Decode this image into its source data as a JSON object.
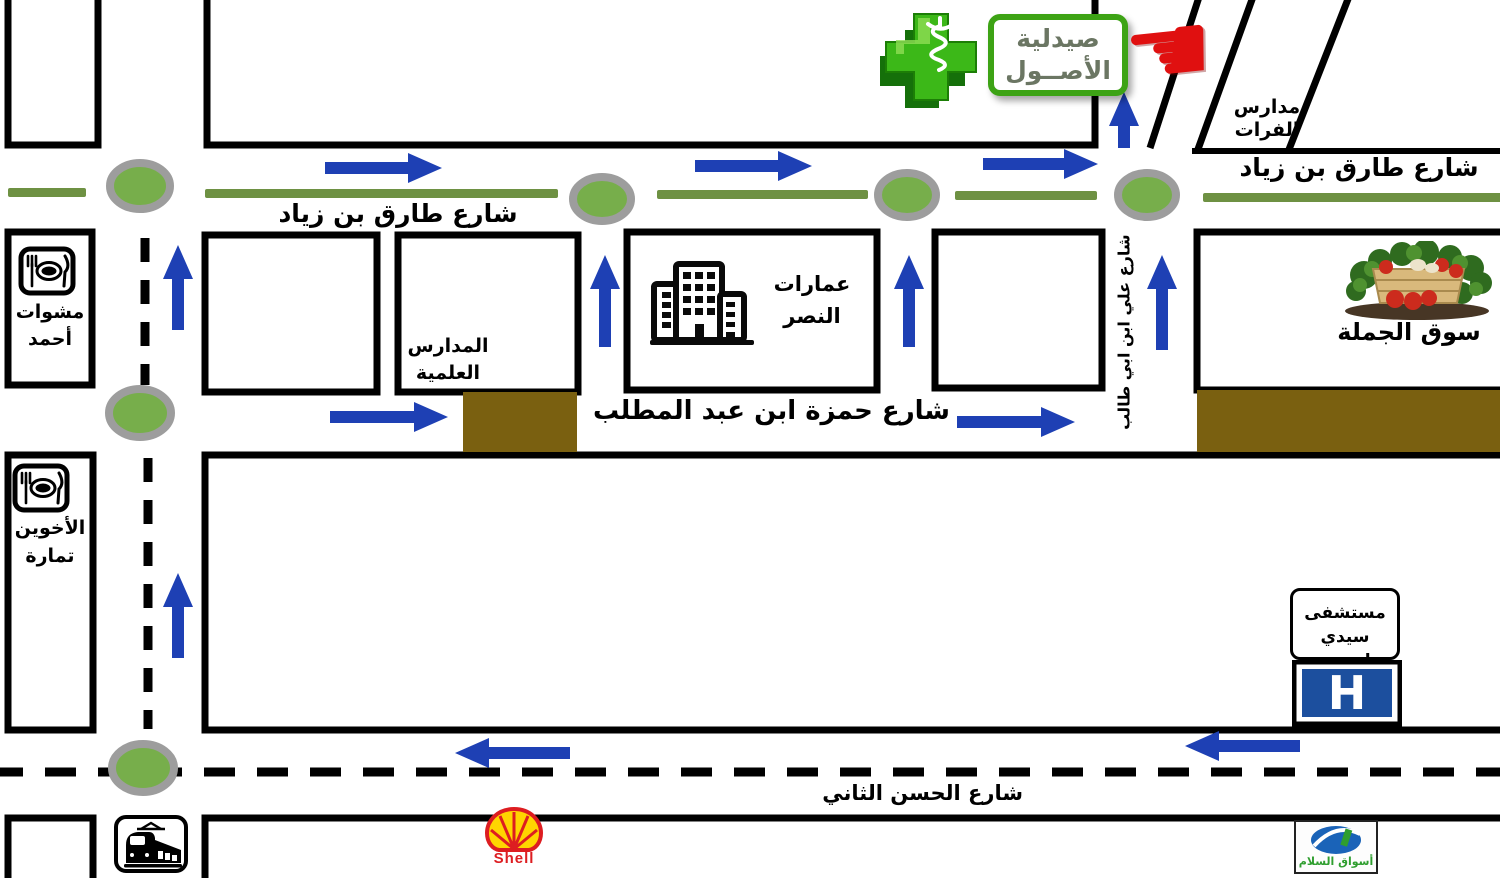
{
  "colors": {
    "arrow-blue": "#1e40b4",
    "oval-green": "#77ae4b",
    "oval-border": "#9d9d9d",
    "median-green": "#6e9143",
    "block-brown": "#7a6010",
    "pharmacy-green": "#3da315",
    "pharmacy-cross": "#3cb818",
    "pharmacy-text": "#6b7663",
    "hand-red": "#e01010",
    "hospital-blue": "#1c4f9e",
    "shell-red": "#dd1d21",
    "shell-yellow": "#ffd500",
    "aswak-blue": "#1a63b8",
    "aswak-green": "#2f9e2f"
  },
  "streets": {
    "tariq_left": "شارع طارق بن زياد",
    "tariq_right": "شارع طارق بن زياد",
    "hamza": "شارع حمزة ابن عبد المطلب",
    "ali": "شارع علي ابن ابي طالب",
    "hassan": "شارع الحسن الثاني"
  },
  "places": {
    "pharmacy": {
      "line1": "صيدلية",
      "line2": "الأصــول"
    },
    "furat_schools": {
      "line1": "مدارس",
      "line2": "الفرات"
    },
    "ahmed_grill": {
      "line1": "مشوات",
      "line2": "أحمد"
    },
    "akhawayn_tamara": {
      "line1": "الأخوين",
      "line2": "تمارة"
    },
    "science_schools": {
      "line1": "المدارس",
      "line2": "العلمية"
    },
    "nasr_buildings": {
      "line1": "عمارات",
      "line2": "النصر"
    },
    "wholesale_market": "سوق الجملة",
    "hospital": {
      "line1": "مستشفى",
      "line2": "سيدي لحسن",
      "sign_letter": "H"
    },
    "shell_station": "Shell",
    "aswak_assalam": "أسواق السلام"
  },
  "icons": {
    "pointing_hand": "☚"
  }
}
